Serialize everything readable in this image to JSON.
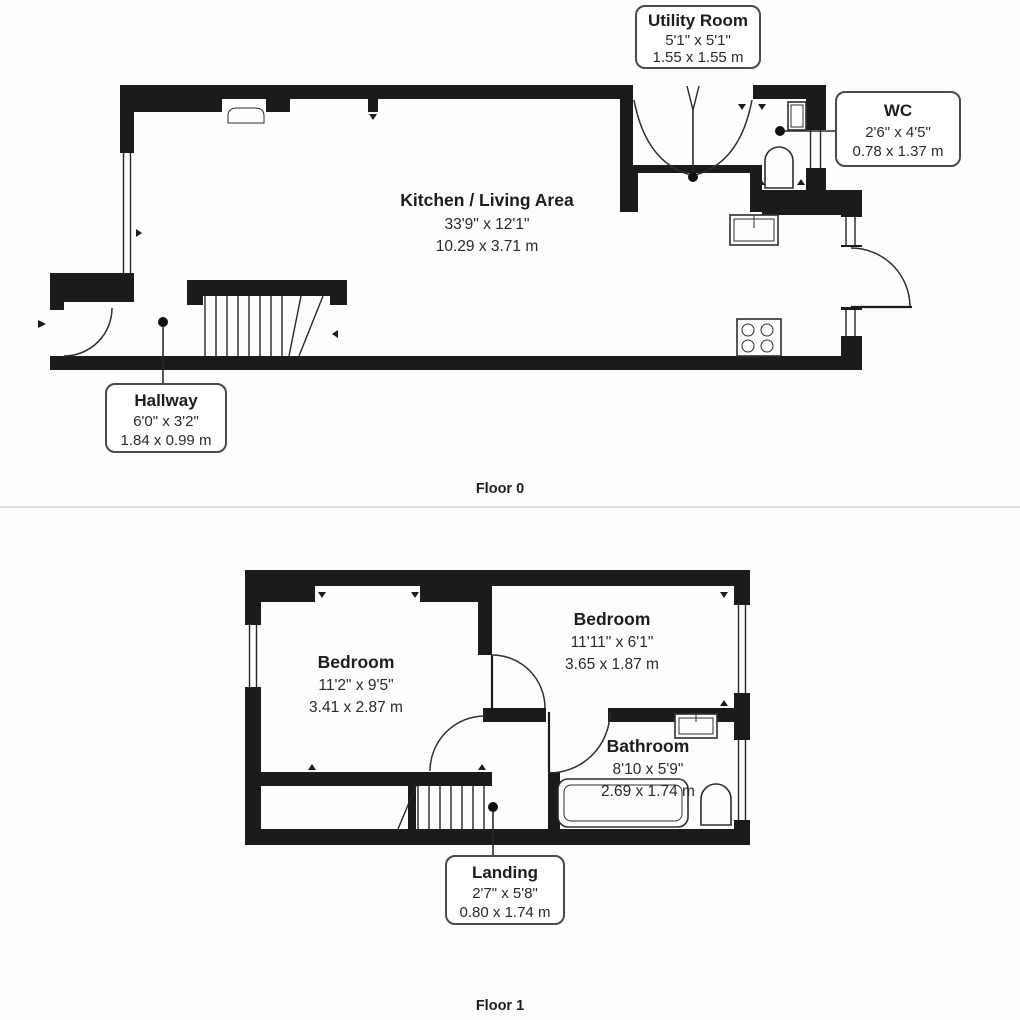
{
  "colors": {
    "wall": "#1b1b1b",
    "line": "#2e2e2e",
    "callout_border": "#4a4a4a",
    "text": "#1d1d1d",
    "divider": "#dcdcdc",
    "background": "#fdfdfd"
  },
  "floors": [
    {
      "name": "Floor 0",
      "rooms": [
        {
          "name": "Utility Room",
          "imperial": "5'1\" x 5'1\"",
          "metric": "1.55 x 1.55 m",
          "label_style": "callout"
        },
        {
          "name": "WC",
          "imperial": "2'6\" x 4'5\"",
          "metric": "0.78 x 1.37 m",
          "label_style": "callout"
        },
        {
          "name": "Kitchen / Living Area",
          "imperial": "33'9\" x 12'1\"",
          "metric": "10.29 x 3.71 m",
          "label_style": "inline"
        },
        {
          "name": "Hallway",
          "imperial": "6'0\" x 3'2\"",
          "metric": "1.84 x 0.99 m",
          "label_style": "callout"
        }
      ]
    },
    {
      "name": "Floor 1",
      "rooms": [
        {
          "name": "Bedroom",
          "imperial": "11'2\" x 9'5\"",
          "metric": "3.41 x 2.87 m",
          "label_style": "inline"
        },
        {
          "name": "Bedroom",
          "imperial": "11'11\" x 6'1\"",
          "metric": "3.65 x 1.87 m",
          "label_style": "inline"
        },
        {
          "name": "Bathroom",
          "imperial": "8'10 x 5'9\"",
          "metric": "2.69 x 1.74 m",
          "label_style": "inline"
        },
        {
          "name": "Landing",
          "imperial": "2'7\" x 5'8\"",
          "metric": "0.80 x 1.74 m",
          "label_style": "callout"
        }
      ]
    }
  ]
}
